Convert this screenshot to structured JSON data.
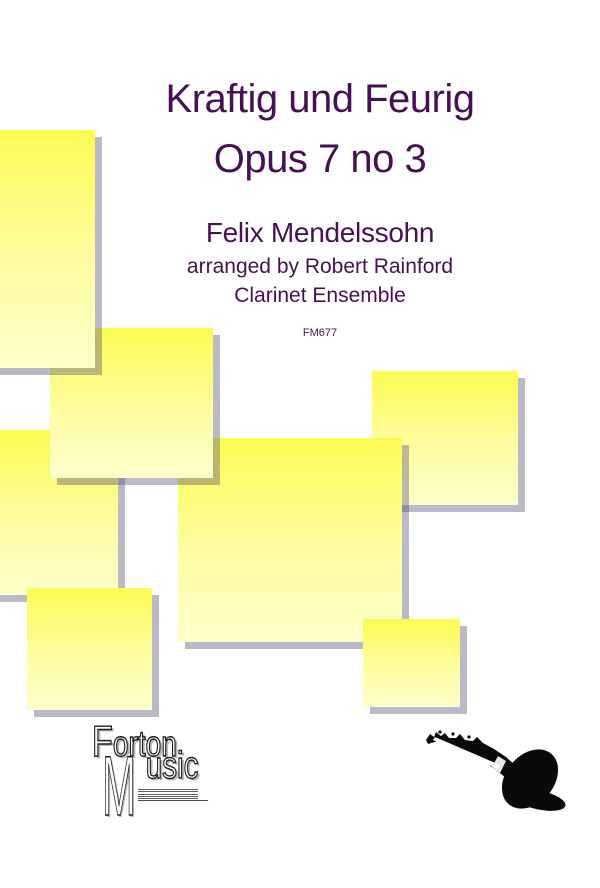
{
  "document": {
    "title_line1": "Kraftig und Feurig",
    "title_line2": "Opus 7 no 3",
    "composer": "Felix Mendelssohn",
    "arranger_line": "arranged by Robert Rainford",
    "ensemble": "Clarinet Ensemble",
    "catalog_number": "FM677"
  },
  "publisher_logo": {
    "line1_initial": "F",
    "line1_rest": "orton",
    "line2_initial": "M",
    "line2_rest": "usic"
  },
  "icons": {
    "clarinet": "clarinet-silhouette",
    "staff_lines": "music-staff-lines"
  },
  "colors": {
    "background": "#ffffff",
    "title_text": "#451152",
    "catalog_text": "#3f3142",
    "square_top": "#fbfb52",
    "square_mid": "#fdfd9e",
    "square_bottom": "#fffecb",
    "square_shadow": "#b7b1c4",
    "logo_ink": "#1c1c1c",
    "clarinet_black": "#0a0a0a"
  }
}
